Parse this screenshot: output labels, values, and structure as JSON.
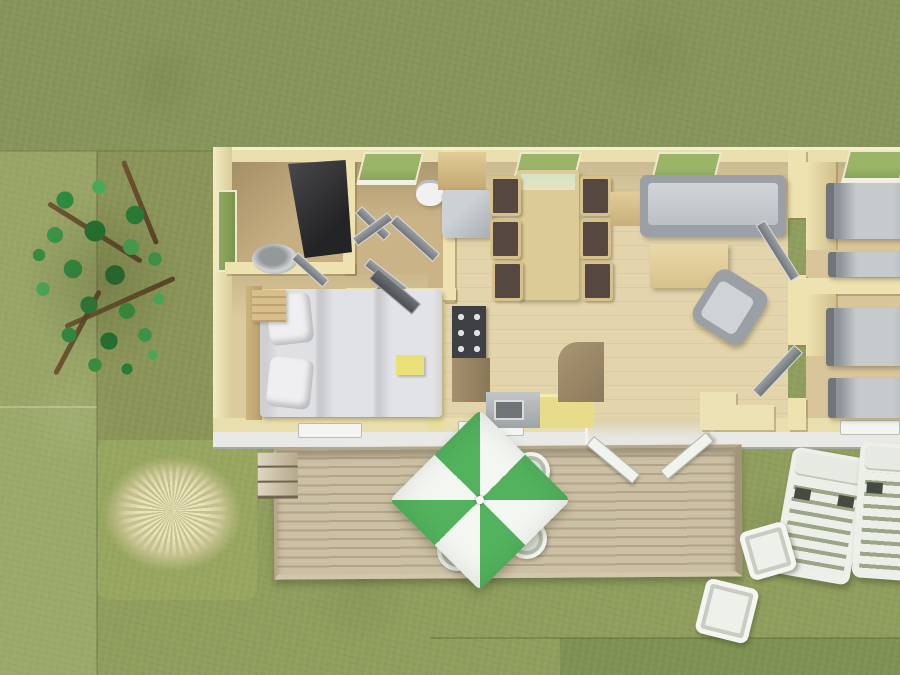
{
  "scene": {
    "description": "Aerial 3D architectural rendering of a rectangular mobile home / chalet on a lawn: bathroom with dark shower and washbasin, WC, hallway with open doors, master bedroom with double bed, kitchen with hob and sink, dining table with six chairs and fridge, living room with sofa, coffee table and armchair, and two bedrooms on the right each with two single beds; a wooden terrace with steps, a green-and-white pinwheel parasol and four white chairs sits below, with a tree, ornamental dry grass, two white sun loungers and two small white tables in the garden.",
    "house": {
      "type": "mobile-home floor plan, top-down 3D render",
      "rooms": [
        {
          "name": "bathroom",
          "furniture": [
            "corner shower",
            "washbasin",
            "side window",
            "door"
          ]
        },
        {
          "name": "wc",
          "furniture": [
            "toilet",
            "window",
            "door"
          ]
        },
        {
          "name": "hallway",
          "furniture": [
            "four open doors"
          ]
        },
        {
          "name": "master-bedroom",
          "furniture": [
            "double bed with two pillows",
            "wood headboard",
            "dresser",
            "wardrobe with open door",
            "yellow side table"
          ]
        },
        {
          "name": "kitchen",
          "furniture": [
            "hob with six burners",
            "counter",
            "sink unit",
            "yellow counter",
            "curved bar counter"
          ]
        },
        {
          "name": "dining-area",
          "furniture": [
            "dining table",
            "six chairs",
            "fridge",
            "cabinet"
          ]
        },
        {
          "name": "living-room",
          "furniture": [
            "sofa",
            "side table",
            "coffee table",
            "armchair",
            "stepped sideboard",
            "two doors"
          ]
        },
        {
          "name": "bedroom-2",
          "furniture": [
            "two single beds",
            "wardrobe"
          ]
        },
        {
          "name": "bedroom-3",
          "furniture": [
            "two single beds",
            "wardrobe"
          ]
        }
      ],
      "window_count": 9
    },
    "terrace": {
      "deck": "wooden plank deck with three steps on the left",
      "parasol": "green and white pinwheel parasol",
      "chair_count": 4,
      "french_doors": "double doors open onto the deck"
    },
    "garden": {
      "tree_count": 1,
      "ornamental_grass_count": 1,
      "sun_lounger_count": 2,
      "side_table_count": 2
    }
  },
  "colors": {
    "grass_base": "#8f9e5d",
    "grass_top": "#87945a",
    "grass_left": "#99a567",
    "grass_left_bottom": "#9ba96a",
    "grass_tree": "#8b9458",
    "grass_bright": "#97a65f",
    "grass_dark": "#7f9152",
    "wall_cream": "#e9dfae",
    "wall_yellow": "#e9df9d",
    "floor_main": "#e3d4ab",
    "floor_dark": "#c5ae81",
    "floor_bedroom": "#dccb9e",
    "floor_right": "#d8c69a",
    "table_wood": "#ddcb97",
    "gray": "#9aa0a5",
    "gray_dark": "#70757a",
    "kitchen_yellow": "#e7dc8a",
    "seat_brown": "#564840",
    "window_green": "#8aa45e",
    "umbrella_green": "#52b25d",
    "umbrella_white": "#f4f6f1",
    "deck": "#c9bca1",
    "lounger_white": "#edefe9"
  }
}
